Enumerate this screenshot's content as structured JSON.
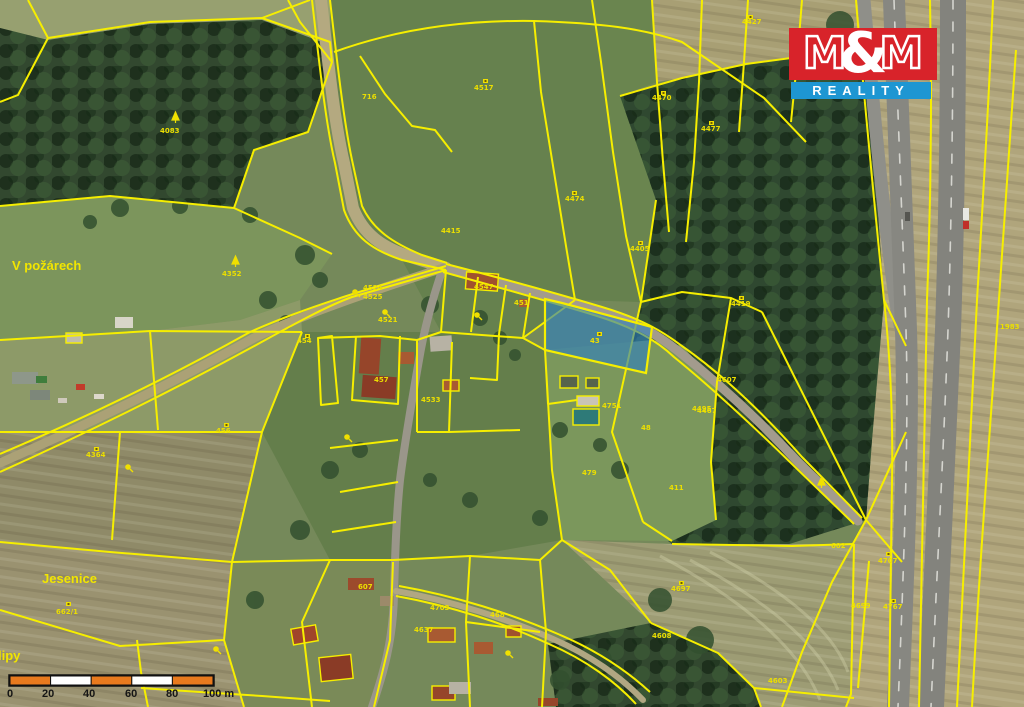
{
  "logo": {
    "m1": "M",
    "amp": "&",
    "m2": "M",
    "word": "REALITY",
    "red": "#d8232a",
    "blue": "#1e96d2"
  },
  "map": {
    "highlight_color": "#2d7fc0",
    "parcel_line_color": "#f6ee00",
    "label_color": "#ecdf00",
    "region_labels": [
      {
        "t": "V požárech",
        "x": 12,
        "y": 270
      },
      {
        "t": "Jesenice",
        "x": 42,
        "y": 583
      },
      {
        "t": "lipy",
        "x": -2,
        "y": 660
      }
    ],
    "parcel_labels": [
      {
        "t": "4083",
        "x": 160,
        "y": 133
      },
      {
        "t": "4352",
        "x": 222,
        "y": 276
      },
      {
        "t": "716",
        "x": 362,
        "y": 99
      },
      {
        "t": "4517",
        "x": 474,
        "y": 90
      },
      {
        "t": "4474",
        "x": 565,
        "y": 201
      },
      {
        "t": "4405",
        "x": 630,
        "y": 251
      },
      {
        "t": "4470",
        "x": 652,
        "y": 100
      },
      {
        "t": "4477",
        "x": 701,
        "y": 131
      },
      {
        "t": "4427",
        "x": 742,
        "y": 24
      },
      {
        "t": "4419",
        "x": 731,
        "y": 306
      },
      {
        "t": "4415",
        "x": 441,
        "y": 233
      },
      {
        "t": "4467",
        "x": 697,
        "y": 413
      },
      {
        "t": "4607",
        "x": 717,
        "y": 382
      },
      {
        "t": "43",
        "x": 590,
        "y": 343
      },
      {
        "t": "451",
        "x": 514,
        "y": 305
      },
      {
        "t": "4547",
        "x": 474,
        "y": 289
      },
      {
        "t": "4524",
        "x": 363,
        "y": 290
      },
      {
        "t": "4525",
        "x": 363,
        "y": 299
      },
      {
        "t": "4521",
        "x": 378,
        "y": 322
      },
      {
        "t": "454",
        "x": 297,
        "y": 343
      },
      {
        "t": "457",
        "x": 374,
        "y": 382
      },
      {
        "t": "4533",
        "x": 421,
        "y": 402
      },
      {
        "t": "456",
        "x": 216,
        "y": 433
      },
      {
        "t": "4364",
        "x": 86,
        "y": 457
      },
      {
        "t": "662/1",
        "x": 56,
        "y": 614
      },
      {
        "t": "4751",
        "x": 602,
        "y": 408
      },
      {
        "t": "48",
        "x": 641,
        "y": 430
      },
      {
        "t": "479",
        "x": 582,
        "y": 475
      },
      {
        "t": "411",
        "x": 669,
        "y": 490
      },
      {
        "t": "4495",
        "x": 692,
        "y": 411
      },
      {
        "t": "4697",
        "x": 671,
        "y": 591
      },
      {
        "t": "602",
        "x": 831,
        "y": 548
      },
      {
        "t": "4699",
        "x": 851,
        "y": 608
      },
      {
        "t": "4707",
        "x": 878,
        "y": 563
      },
      {
        "t": "4767",
        "x": 883,
        "y": 609
      },
      {
        "t": "4603",
        "x": 768,
        "y": 683
      },
      {
        "t": "4608",
        "x": 652,
        "y": 638
      },
      {
        "t": "607",
        "x": 358,
        "y": 589
      },
      {
        "t": "4637",
        "x": 414,
        "y": 632
      },
      {
        "t": "4703",
        "x": 430,
        "y": 610
      },
      {
        "t": "468",
        "x": 490,
        "y": 617
      },
      {
        "t": "1983",
        "x": 1000,
        "y": 329
      }
    ],
    "symbols": {
      "markers": [
        {
          "x": 483,
          "y": 79
        },
        {
          "x": 572,
          "y": 191
        },
        {
          "x": 638,
          "y": 241
        },
        {
          "x": 661,
          "y": 91
        },
        {
          "x": 709,
          "y": 121
        },
        {
          "x": 739,
          "y": 296
        },
        {
          "x": 597,
          "y": 332
        },
        {
          "x": 305,
          "y": 334
        },
        {
          "x": 224,
          "y": 423
        },
        {
          "x": 94,
          "y": 447
        },
        {
          "x": 66,
          "y": 602
        },
        {
          "x": 679,
          "y": 581
        },
        {
          "x": 886,
          "y": 552
        },
        {
          "x": 891,
          "y": 599
        },
        {
          "x": 748,
          "y": 15
        }
      ],
      "conifers": [
        {
          "x": 172,
          "y": 112
        },
        {
          "x": 232,
          "y": 256
        },
        {
          "x": 818,
          "y": 477
        }
      ],
      "trees": [
        {
          "x": 355,
          "y": 292
        },
        {
          "x": 385,
          "y": 312
        },
        {
          "x": 347,
          "y": 437
        },
        {
          "x": 216,
          "y": 649
        },
        {
          "x": 477,
          "y": 315
        },
        {
          "x": 508,
          "y": 653
        },
        {
          "x": 128,
          "y": 467
        }
      ]
    }
  },
  "scale_bar": {
    "ticks": [
      {
        "l": "0",
        "x": -3
      },
      {
        "l": "20",
        "x": 32
      },
      {
        "l": "40",
        "x": 73
      },
      {
        "l": "60",
        "x": 115
      },
      {
        "l": "80",
        "x": 156
      },
      {
        "l": "100 m",
        "x": 193
      }
    ],
    "orange": "#e87a1e",
    "white": "#ffffff"
  }
}
